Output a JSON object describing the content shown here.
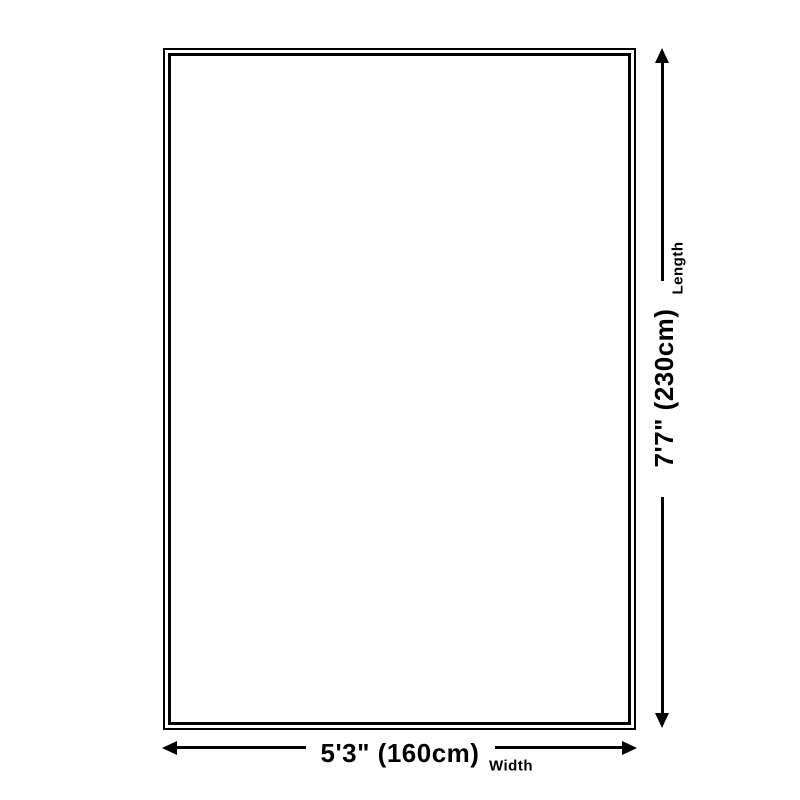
{
  "diagram": {
    "type": "rug-size-dimension-diagram",
    "colors": {
      "background": "#ffffff",
      "line": "#000000",
      "text": "#000000"
    },
    "rug": {
      "shape": "rectangle",
      "border_style": "double"
    },
    "length": {
      "value": "7'7\" (230cm)",
      "label": "Length",
      "orientation": "vertical"
    },
    "width": {
      "value": "5'3\" (160cm)",
      "label": "Width",
      "orientation": "horizontal"
    },
    "icons": {
      "up": "arrow-up-icon",
      "down": "arrow-down-icon",
      "left": "arrow-left-icon",
      "right": "arrow-right-icon"
    }
  }
}
